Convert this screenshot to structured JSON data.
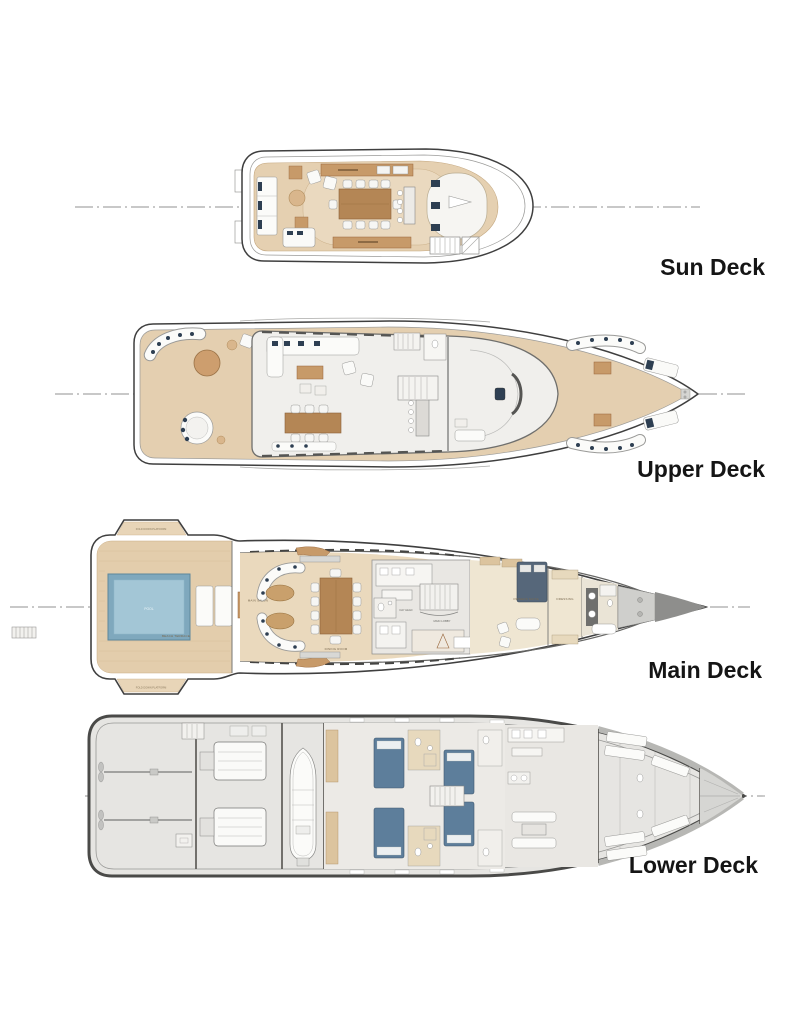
{
  "decks": [
    {
      "id": "sun",
      "label": "Sun Deck"
    },
    {
      "id": "upper",
      "label": "Upper Deck"
    },
    {
      "id": "main",
      "label": "Main Deck",
      "rooms": {
        "fold_down_platform": "FOLD DOWN PLATFORM",
        "pool": "POOL",
        "beach_terrace": "BEACH TERRACE",
        "main_salon": "MAIN SALON",
        "dining_room": "DINING ROOM",
        "day_head": "DAY HEAD",
        "main_lobby": "MAIN LOBBY",
        "owners_suite": "OWNERS SUITE",
        "dressing": "DRESSING"
      }
    },
    {
      "id": "lower",
      "label": "Lower Deck"
    }
  ],
  "colors": {
    "background": "#ffffff",
    "hull_line": "#3f3f3f",
    "deck_wood": "#e5d0b1",
    "wood_cabinet": "#c79a69",
    "table_brown": "#b48655",
    "interior_gray": "#ececea",
    "cushion_navy": "#2e3f52",
    "pool_blue": "#a3c6d6",
    "bed_blue": "#5d7e9b",
    "bow_gray": "#8e8e8c",
    "label_text": "#151515"
  }
}
